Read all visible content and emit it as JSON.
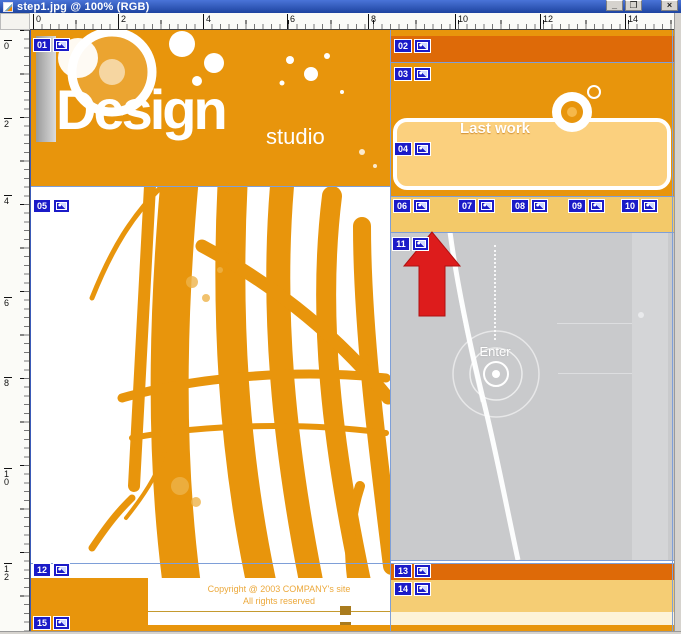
{
  "window": {
    "title": "step1.jpg @ 100% (RGB)",
    "buttons": [
      {
        "name": "minimize",
        "glyph": "_"
      },
      {
        "name": "maximize",
        "glyph": "❐"
      },
      {
        "name": "close",
        "glyph": "×"
      }
    ]
  },
  "rulers": {
    "horizontal": [
      {
        "label": "0",
        "x": 3
      },
      {
        "label": "2",
        "x": 88
      },
      {
        "label": "4",
        "x": 173
      },
      {
        "label": "6",
        "x": 257
      },
      {
        "label": "8",
        "x": 338
      },
      {
        "label": "10",
        "x": 425
      },
      {
        "label": "12",
        "x": 510
      },
      {
        "label": "14",
        "x": 595
      }
    ],
    "vertical": [
      {
        "label": "0",
        "y": 10
      },
      {
        "label": "2",
        "y": 88
      },
      {
        "label": "4",
        "y": 165
      },
      {
        "label": "6",
        "y": 267
      },
      {
        "label": "8",
        "y": 347
      },
      {
        "label": "10",
        "y": 438
      },
      {
        "label": "12",
        "y": 533
      }
    ]
  },
  "slices": [
    {
      "num": "01",
      "x": 3,
      "y": 8
    },
    {
      "num": "02",
      "x": 364,
      "y": 9
    },
    {
      "num": "03",
      "x": 364,
      "y": 37
    },
    {
      "num": "04",
      "x": 364,
      "y": 112
    },
    {
      "num": "05",
      "x": 3,
      "y": 169
    },
    {
      "num": "06",
      "x": 363,
      "y": 169
    },
    {
      "num": "07",
      "x": 428,
      "y": 169
    },
    {
      "num": "08",
      "x": 481,
      "y": 169
    },
    {
      "num": "09",
      "x": 538,
      "y": 169
    },
    {
      "num": "10",
      "x": 591,
      "y": 169
    },
    {
      "num": "11",
      "x": 362,
      "y": 207
    },
    {
      "num": "12",
      "x": 3,
      "y": 533
    },
    {
      "num": "13",
      "x": 364,
      "y": 534
    },
    {
      "num": "14",
      "x": 364,
      "y": 552
    },
    {
      "num": "15",
      "x": 3,
      "y": 586
    }
  ],
  "logo": {
    "title": "Design",
    "subtitle": "studio"
  },
  "last_work": {
    "label": "Last work"
  },
  "nav": {
    "items": [
      {
        "label": "About Us",
        "x": 360,
        "w": 65
      },
      {
        "label": "Design",
        "x": 425,
        "w": 52
      },
      {
        "label": "Portfolio",
        "x": 477,
        "w": 58
      },
      {
        "label": "Pricing",
        "x": 535,
        "w": 53
      },
      {
        "label": "Contact",
        "x": 588,
        "w": 56
      }
    ]
  },
  "enter": {
    "label": "Enter"
  },
  "footer": {
    "line1": "Copyright @ 2003 COMPANY's site",
    "line2": "All rights reserved"
  },
  "colors": {
    "orange": "#e8950c",
    "dark_orange": "#de6a08",
    "tan": "#f3c969",
    "panel_fill": "#fbd07e",
    "nav_text": "#e0791c",
    "gray_panel": "#c9cacc",
    "badge_blue": "#1b1bc8",
    "arrow_red": "#dd1c1c",
    "guide_blue": "#7e9fd8",
    "titlebar_blue": "#1e44a0"
  }
}
